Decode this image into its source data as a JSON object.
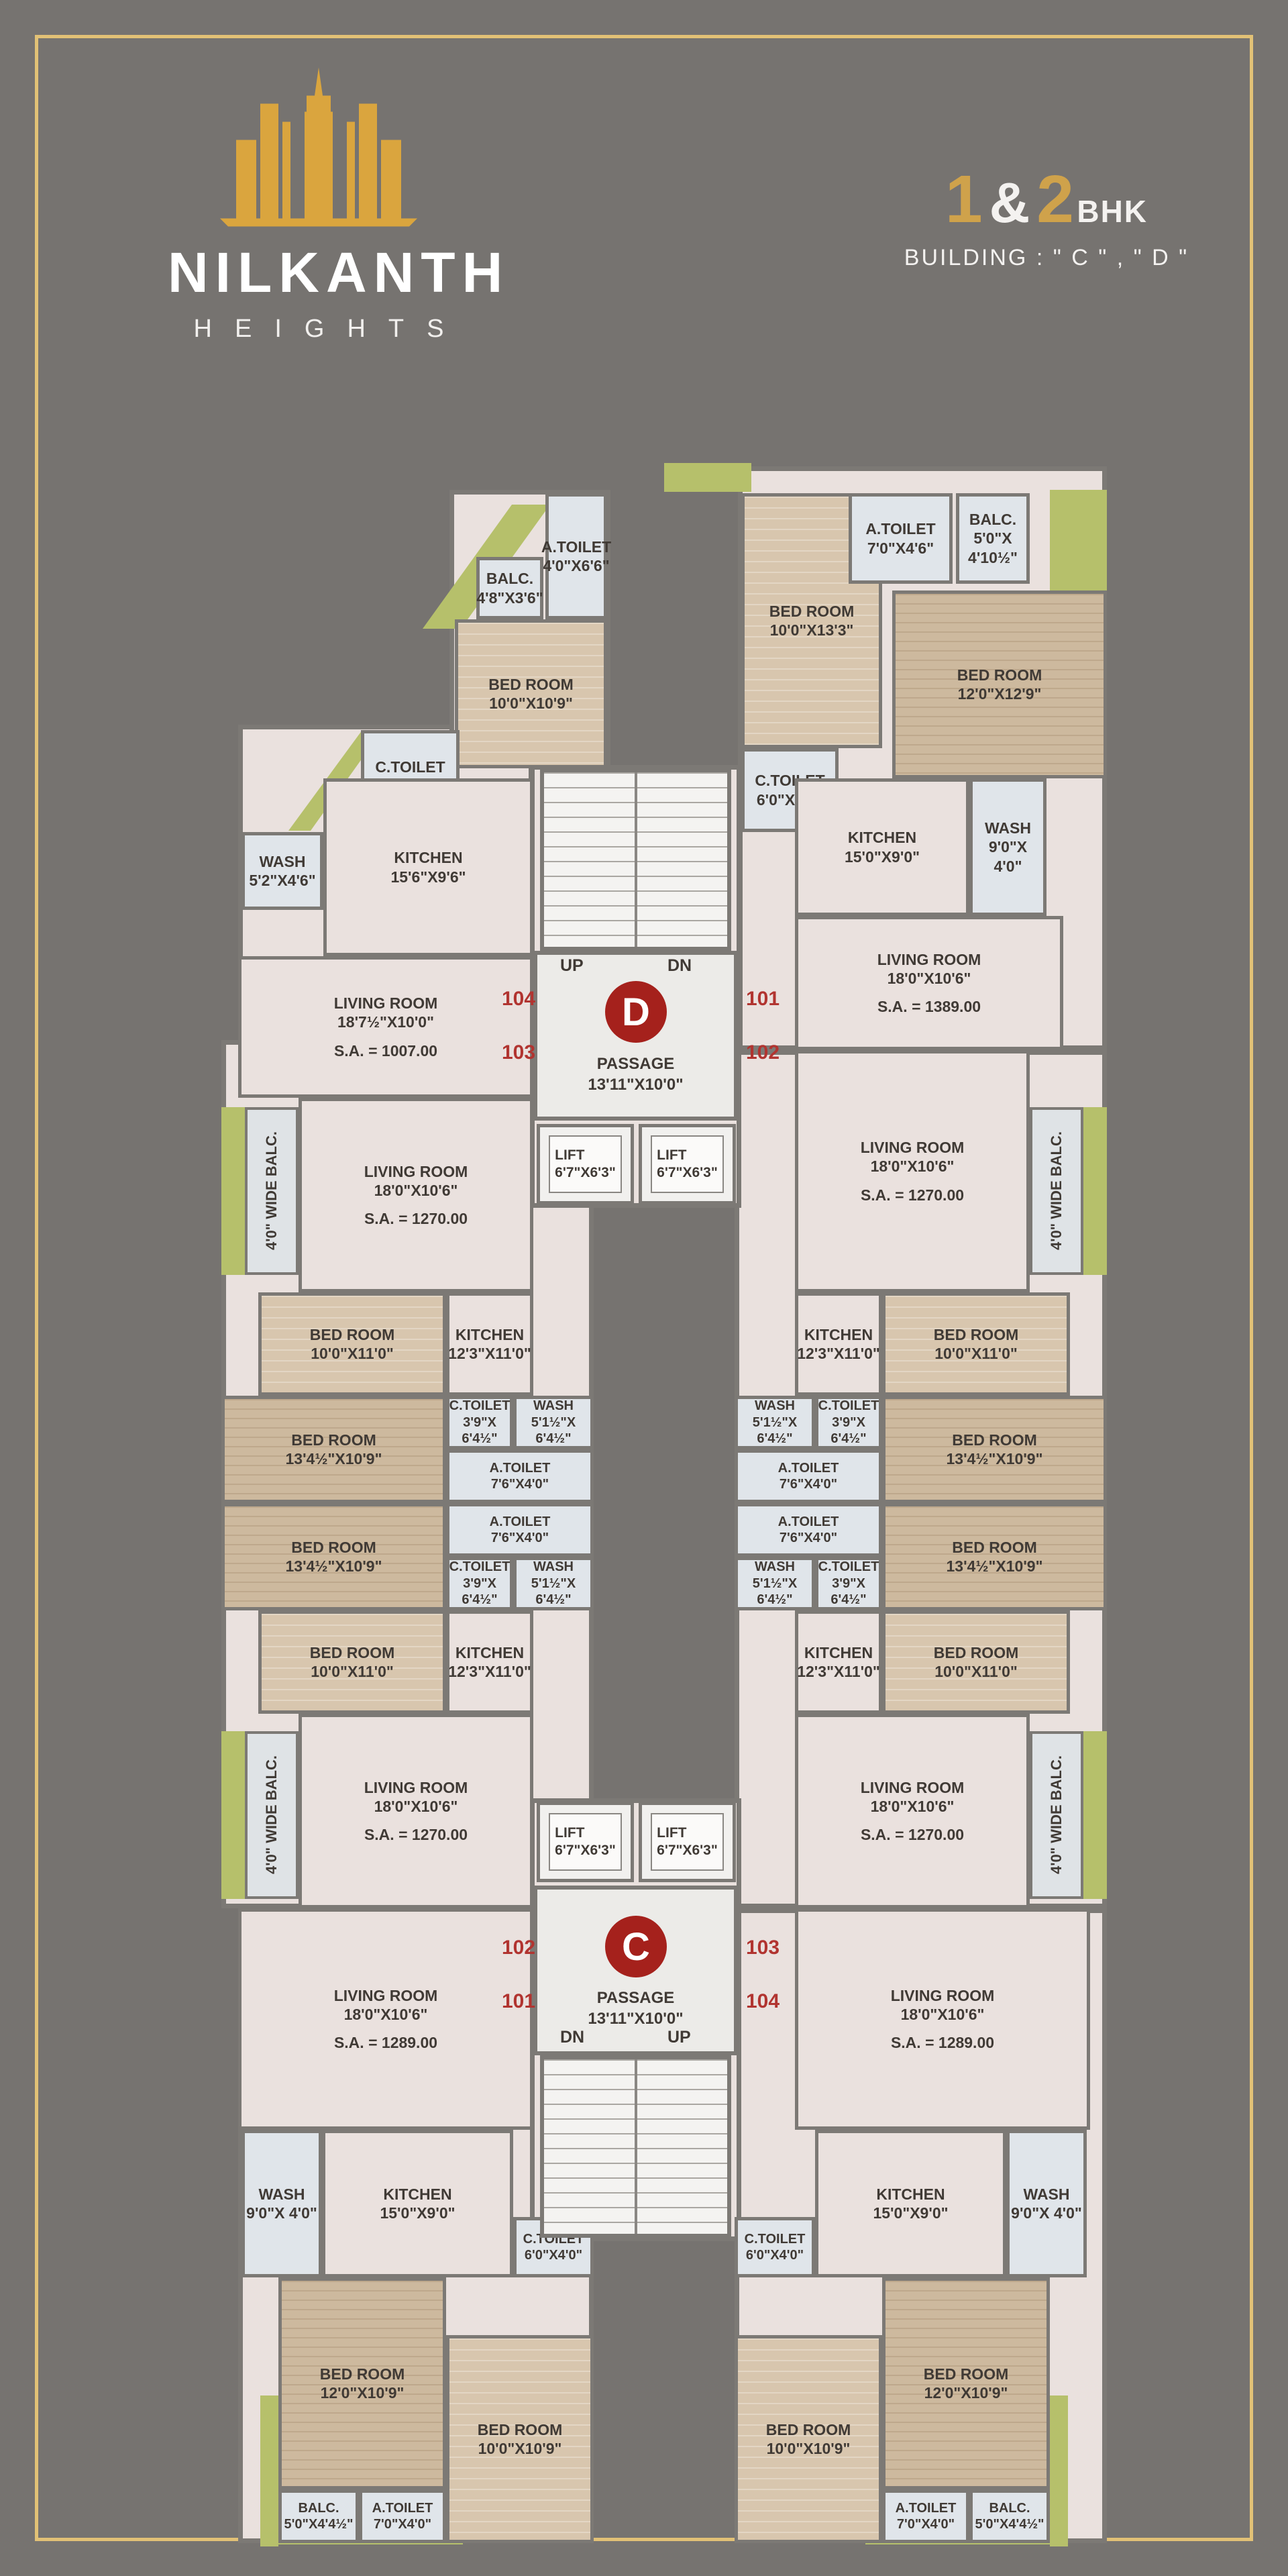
{
  "page": {
    "bg": "#767370",
    "frame": "#e2c176",
    "accent_gold": "#cfa24b",
    "unit_red": "#b13430",
    "badge_red": "#a5211c",
    "balcony_green": "#b6c06b"
  },
  "brand": {
    "name": "NILKANTH",
    "tagline": "HEIGHTS"
  },
  "title": {
    "n1": "1",
    "amp": "&",
    "n2": "2",
    "bhk": "BHK",
    "building": "BUILDING : \" C \" , \" D \""
  },
  "core": {
    "badge_d": "D",
    "badge_c": "C",
    "up": "UP",
    "dn": "DN",
    "passage": {
      "n": "PASSAGE",
      "d": "13'11\"X10'0\""
    },
    "lift": {
      "n": "LIFT",
      "d": "6'7\"X6'3\""
    }
  },
  "numbers": {
    "d": {
      "tl": "104",
      "bl": "103",
      "tr": "101",
      "br": "102"
    },
    "c": {
      "tl": "102",
      "bl": "101",
      "tr": "103",
      "br": "104"
    }
  },
  "rooms": {
    "living1007": {
      "n": "LIVING ROOM",
      "d": "18'7½\"X10'0\"",
      "sa": "S.A. = 1007.00"
    },
    "living1389": {
      "n": "LIVING ROOM",
      "d": "18'0\"X10'6\"",
      "sa": "S.A. = 1389.00"
    },
    "living1270": {
      "n": "LIVING ROOM",
      "d": "18'0\"X10'6\"",
      "sa": "S.A. = 1270.00"
    },
    "living1289": {
      "n": "LIVING ROOM",
      "d": "18'0\"X10'6\"",
      "sa": "S.A. = 1289.00"
    },
    "bed10x109": {
      "n": "BED ROOM",
      "d": "10'0\"X10'9\""
    },
    "bed10x133": {
      "n": "BED ROOM",
      "d": "10'0\"X13'3\""
    },
    "bed12x129": {
      "n": "BED ROOM",
      "d": "12'0\"X12'9\""
    },
    "bed10x11": {
      "n": "BED ROOM",
      "d": "10'0\"X11'0\""
    },
    "bed134": {
      "n": "BED ROOM",
      "d": "13'4½\"X10'9\""
    },
    "bed12x109": {
      "n": "BED ROOM",
      "d": "12'0\"X10'9\""
    },
    "kitchen156": {
      "n": "KITCHEN",
      "d": "15'6\"X9'6\""
    },
    "kitchen15": {
      "n": "KITCHEN",
      "d": "15'0\"X9'0\""
    },
    "kitchen123": {
      "n": "KITCHEN",
      "d": "12'3\"X11'0\""
    },
    "wash52": {
      "n": "WASH",
      "d": "5'2\"X4'6\""
    },
    "wash9": {
      "n": "WASH",
      "d": "9'0\"X 4'0\""
    },
    "wash51": {
      "n": "WASH",
      "d": "5'1½\"X 6'4½\""
    },
    "ctoilet748": {
      "n": "C.TOILET",
      "d": "7'0\"X4'8\""
    },
    "ctoilet6": {
      "n": "C.TOILET",
      "d": "6'0\"X4'0\""
    },
    "ctoilet39": {
      "n": "C.TOILET",
      "d": "3'9\"X 6'4½\""
    },
    "atoilet46": {
      "n": "A.TOILET",
      "d": "4'0\"X6'6\""
    },
    "atoilet746": {
      "n": "A.TOILET",
      "d": "7'0\"X4'6\""
    },
    "atoilet76": {
      "n": "A.TOILET",
      "d": "7'6\"X4'0\""
    },
    "atoilet74": {
      "n": "A.TOILET",
      "d": "7'0\"X4'0\""
    },
    "balc48": {
      "n": "BALC.",
      "d": "4'8\"X3'6\""
    },
    "balc5105": {
      "n": "BALC.",
      "d": "5'0\"X 4'10½\""
    },
    "balc544": {
      "n": "BALC.",
      "d": "5'0\"X4'4½\""
    },
    "balcstrip": "4'0\" WIDE BALC."
  }
}
